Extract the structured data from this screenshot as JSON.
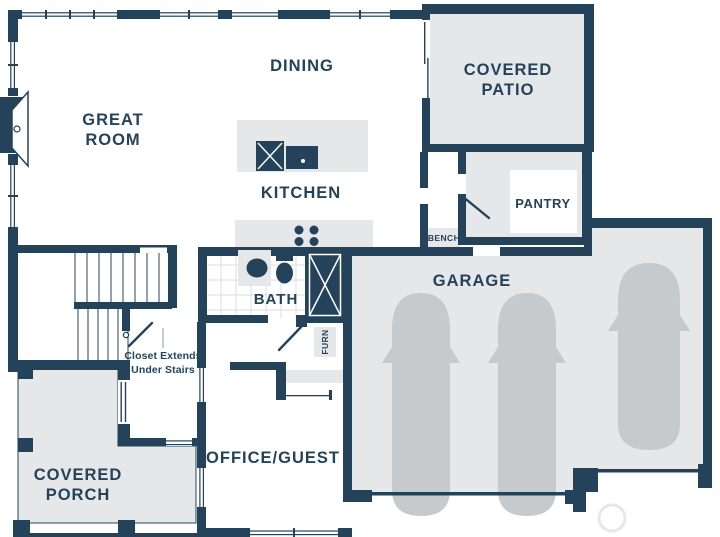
{
  "title": "First floor plan",
  "colors": {
    "wall": "#24435b",
    "area_fill": "#e5e7e8",
    "car_fill": "#c6cacd",
    "text": "#24435b",
    "background": "#ffffff"
  },
  "plan": {
    "rooms": {
      "great_room": {
        "label": "GREAT\nROOM"
      },
      "dining": {
        "label": "DINING"
      },
      "kitchen": {
        "label": "KITCHEN"
      },
      "covered_patio": {
        "label": "COVERED\nPATIO"
      },
      "pantry": {
        "label": "PANTRY"
      },
      "garage": {
        "label": "GARAGE",
        "cars": 3
      },
      "bath": {
        "label": "BATH"
      },
      "office_guest": {
        "label": "OFFICE/GUEST"
      },
      "covered_porch": {
        "label": "COVERED\nPORCH"
      }
    },
    "features": {
      "bench": {
        "label": "BENCH"
      },
      "furnace": {
        "label": "FURN"
      },
      "closet_note": {
        "label": "Closet Extends\nUnder Stairs"
      }
    }
  }
}
